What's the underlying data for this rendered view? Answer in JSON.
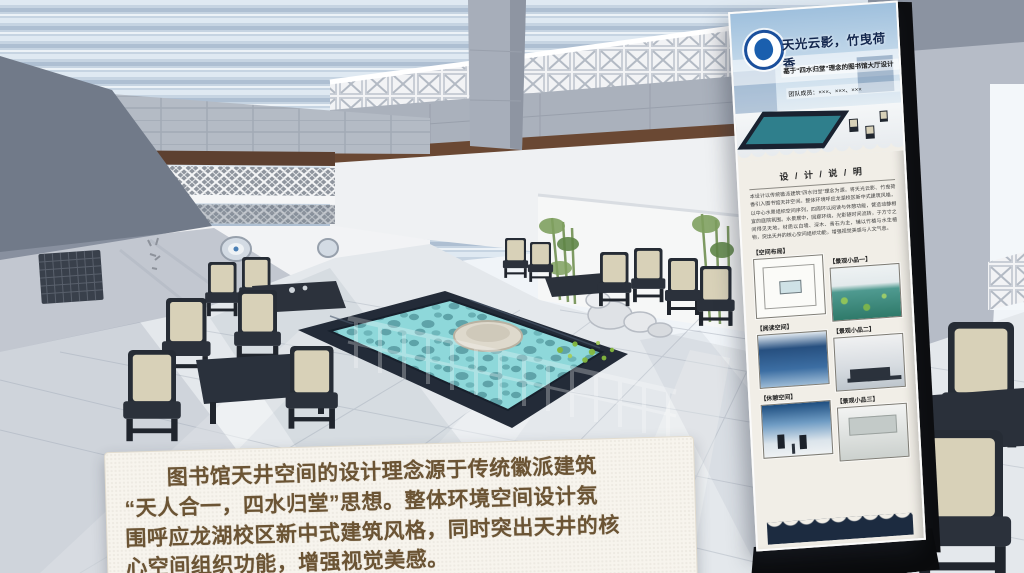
{
  "caption": {
    "text": "　　图书馆天井空间的设计理念源于传统徽派建筑\n“天人合一，四水归堂”思想。整体环境空间设计氛\n围呼应龙湖校区新中式建筑风格，同时突出天井的核\n心空间组织功能，增强视觉美感。"
  },
  "poster": {
    "title": "天光云影，竹曳荷香",
    "subtitle": "基于“四水归堂”理念的图书馆大厅设计",
    "team_line": "团队成员：×××、×××、×××",
    "section_header": "设 / 计 / 说 / 明",
    "description": "本设计以传统徽派建筑“四水归堂”理念为源，将天光云影、竹曳荷香引入图书馆天井空间。整体环境呼应龙湖校区新中式建筑风格，以中心水景组织空间序列，四周环以阅读与休憩功能，营造动静相宜的庭院氛围。水景居中，回廊环绕，光影随时间流转，于方寸之间得见天地。材质以白墙、深木、青石为主，辅以竹植与水生植物，突出天井的核心空间组织功能，增强视觉美感与人文气息。",
    "gallery": {
      "left": [
        {
          "label": "【空间布局】"
        },
        {
          "label": "【阅读空间】"
        },
        {
          "label": "【休憩空间】"
        }
      ],
      "right": [
        {
          "label": "【景观小品一】"
        },
        {
          "label": "【景观小品二】"
        },
        {
          "label": "【景观小品三】"
        }
      ]
    },
    "logo_name": "academy-emblem"
  },
  "colors": {
    "poster_navy": "#16284d",
    "wave_band": "#1c2b40",
    "water": "#8ed8da",
    "pool_rim": "#232b38",
    "cushion": "#d8d1b8",
    "chair_frame": "#262c35",
    "caption_text": "#6b5434",
    "caption_bg": "#f7f4ed"
  }
}
